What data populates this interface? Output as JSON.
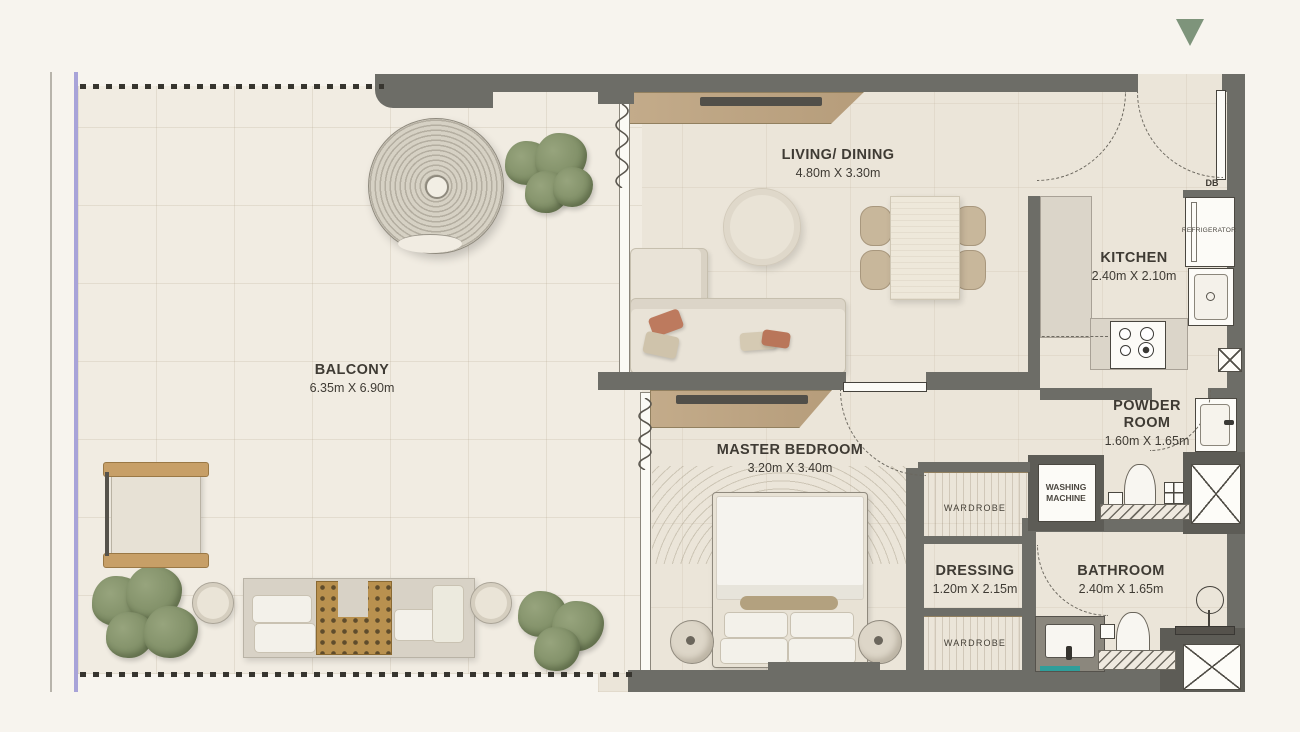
{
  "rooms": {
    "balcony": {
      "name": "BALCONY",
      "dims": "6.35m X 6.90m"
    },
    "living": {
      "name": "LIVING/ DINING",
      "dims": "4.80m X 3.30m"
    },
    "kitchen": {
      "name": "KITCHEN",
      "dims": "2.40m X 2.10m"
    },
    "master_bedroom": {
      "name": "MASTER BEDROOM",
      "dims": "3.20m X 3.40m"
    },
    "powder_room": {
      "name": "POWDER ROOM",
      "dims": "1.60m X 1.65m"
    },
    "dressing": {
      "name": "DRESSING",
      "dims": "1.20m X 2.15m"
    },
    "bathroom": {
      "name": "BATHROOM",
      "dims": "2.40m X 1.65m"
    }
  },
  "fixtures": {
    "db": "DB",
    "refrigerator": "REFRIGERATOR",
    "washing_machine_line1": "WASHING",
    "washing_machine_line2": "MACHINE",
    "wardrobe_upper": "WARDROBE",
    "wardrobe_lower": "WARDROBE"
  },
  "colors": {
    "wall": "#6d6d67",
    "unit_floor": "#ebe5d9",
    "balcony_floor": "#f1ece2",
    "wood": "#c3ab8a",
    "plant_green": "#8a9770",
    "accent_teal": "#2f9e9a",
    "boundary_purple": "#a8a3d8",
    "marker_green": "#7e947b",
    "text": "#3f3b34"
  }
}
